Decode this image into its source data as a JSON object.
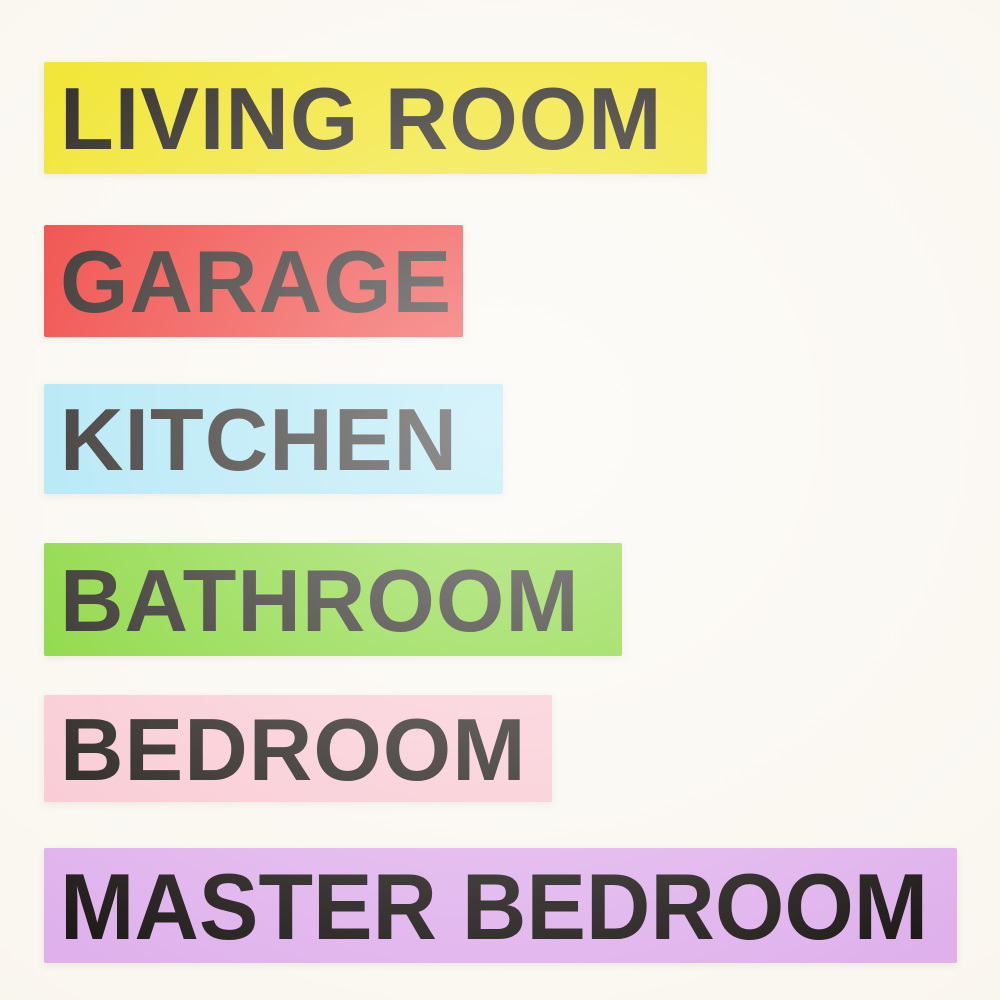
{
  "photo": {
    "background_color": "#faf7f0",
    "text_color": "#1a1613"
  },
  "labels": [
    {
      "text": "LIVING ROOM",
      "color": "#f0e320"
    },
    {
      "text": "GARAGE",
      "color": "#ee3430"
    },
    {
      "text": "KITCHEN",
      "color": "#a8e4f4"
    },
    {
      "text": "BATHROOM",
      "color": "#80d42e"
    },
    {
      "text": "BEDROOM",
      "color": "#f9c8d2"
    },
    {
      "text": "MASTER BEDROOM",
      "color": "#dfb0ec"
    }
  ]
}
